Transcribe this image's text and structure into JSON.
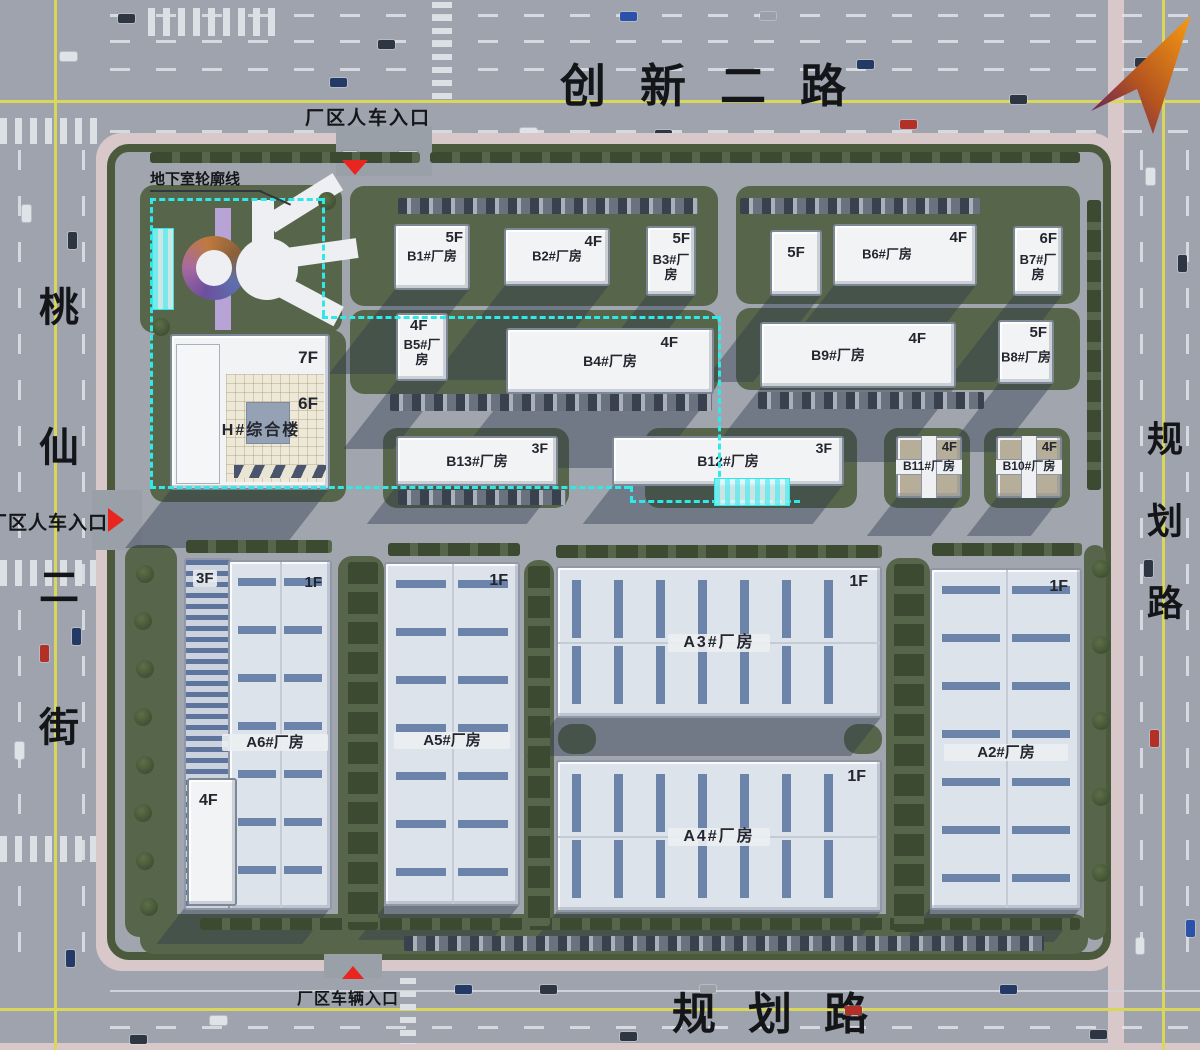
{
  "plan": {
    "roads": {
      "top": "创新二路",
      "left": "桃仙二街",
      "right": "规划路",
      "bottom": "规划路"
    },
    "entrances": {
      "top": "厂区人车入口",
      "left": "厂区人车入口",
      "bottom": "厂区车辆入口"
    },
    "annotations": {
      "basement_outline": "地下室轮廓线"
    },
    "buildings": {
      "b1": {
        "name": "B1#厂房",
        "floors": "5F"
      },
      "b2": {
        "name": "B2#厂房",
        "floors": "4F"
      },
      "b3": {
        "name": "B3#厂房",
        "floors": "5F"
      },
      "b_5f": {
        "floors": "5F"
      },
      "b6": {
        "name": "B6#厂房",
        "floors": "4F"
      },
      "b7": {
        "name": "B7#厂房",
        "floors": "6F"
      },
      "b5": {
        "name": "B5#厂房",
        "floors": "4F"
      },
      "b4": {
        "name": "B4#厂房",
        "floors": "4F"
      },
      "b9": {
        "name": "B9#厂房",
        "floors": "4F"
      },
      "b8": {
        "name": "B8#厂房",
        "floors": "5F"
      },
      "b13": {
        "name": "B13#厂房",
        "floors": "3F"
      },
      "b12": {
        "name": "B12#厂房",
        "floors": "3F"
      },
      "b11": {
        "name": "B11#厂房",
        "floors": "4F"
      },
      "b10": {
        "name": "B10#厂房",
        "floors": "4F"
      },
      "h": {
        "name": "H#综合楼",
        "floors_top": "7F",
        "floors_main": "6F"
      },
      "a6": {
        "name": "A6#厂房",
        "floors": "1F",
        "annex_floors": "3F",
        "tower_floors": "4F"
      },
      "a5": {
        "name": "A5#厂房",
        "floors": "1F"
      },
      "a3": {
        "name": "A3#厂房",
        "floors": "1F"
      },
      "a4": {
        "name": "A4#厂房",
        "floors": "1F"
      },
      "a2": {
        "name": "A2#厂房",
        "floors": "1F"
      }
    },
    "colors": {
      "road": "#9ea3ad",
      "lawn": "#57664a",
      "sidewalk": "#d9c8c9",
      "building_white": "#f2f3f5",
      "roof_stripe_blue": "#6d84aa",
      "basement_line_cyan": "#2fe9e9",
      "entrance_marker_red": "#e8251f",
      "road_center_yellow": "#d9d75a",
      "compass_orange": "#f79b13",
      "compass_purple": "#56176b"
    }
  }
}
